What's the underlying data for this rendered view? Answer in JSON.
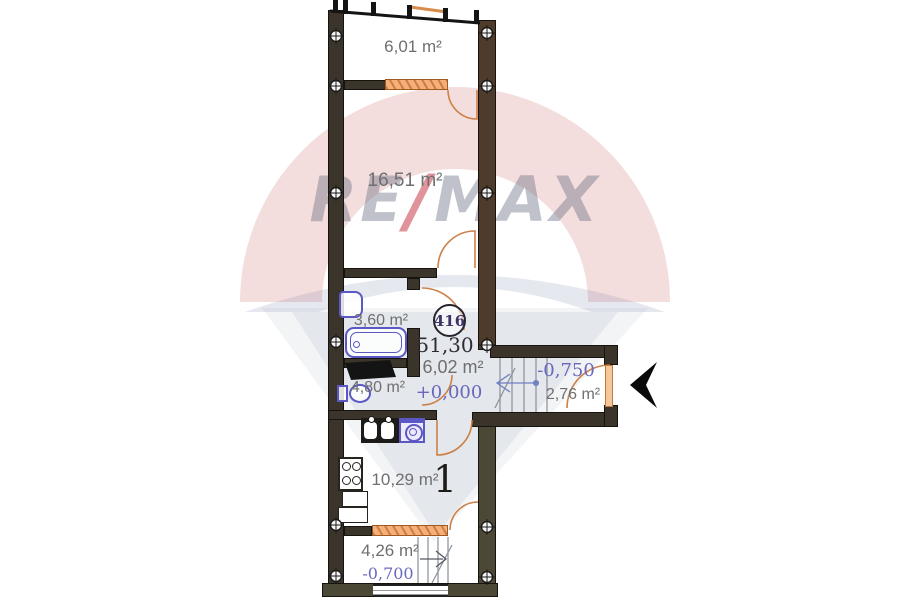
{
  "watermark": {
    "brand_left": "RE",
    "brand_slash": "/",
    "brand_right": "MAX"
  },
  "unit": {
    "number": "416",
    "total_area": "51,30"
  },
  "rooms": [
    {
      "id": "balcony-top",
      "area_label": "6,01 m²"
    },
    {
      "id": "living-room",
      "area_label": "16,51 m²"
    },
    {
      "id": "bathroom",
      "area_label": "3,60 m²"
    },
    {
      "id": "wc",
      "area_label": "4,80 m²"
    },
    {
      "id": "hallway",
      "area_label": "6,02 m²",
      "level_mark": "+0,000"
    },
    {
      "id": "entry-landing",
      "area_label": "2,76 m²",
      "level_mark": "-0,750"
    },
    {
      "id": "kitchen",
      "area_label": "10,29 m²",
      "room_number": "1"
    },
    {
      "id": "balcony-bottom",
      "area_label": "4,26 m²",
      "level_mark": "-0,700"
    }
  ],
  "colors": {
    "wall": "#3a342b",
    "wall_brown": "#4e3b2b",
    "wall_olive": "#4c4836",
    "window_orange": "#f4b078",
    "fixture_blue": "#5b57c4",
    "level_text": "#6a68bd",
    "area_text": "#6f6f6f",
    "brand_red": "#c32837",
    "entrance_arrow": "#0a0a0a"
  }
}
